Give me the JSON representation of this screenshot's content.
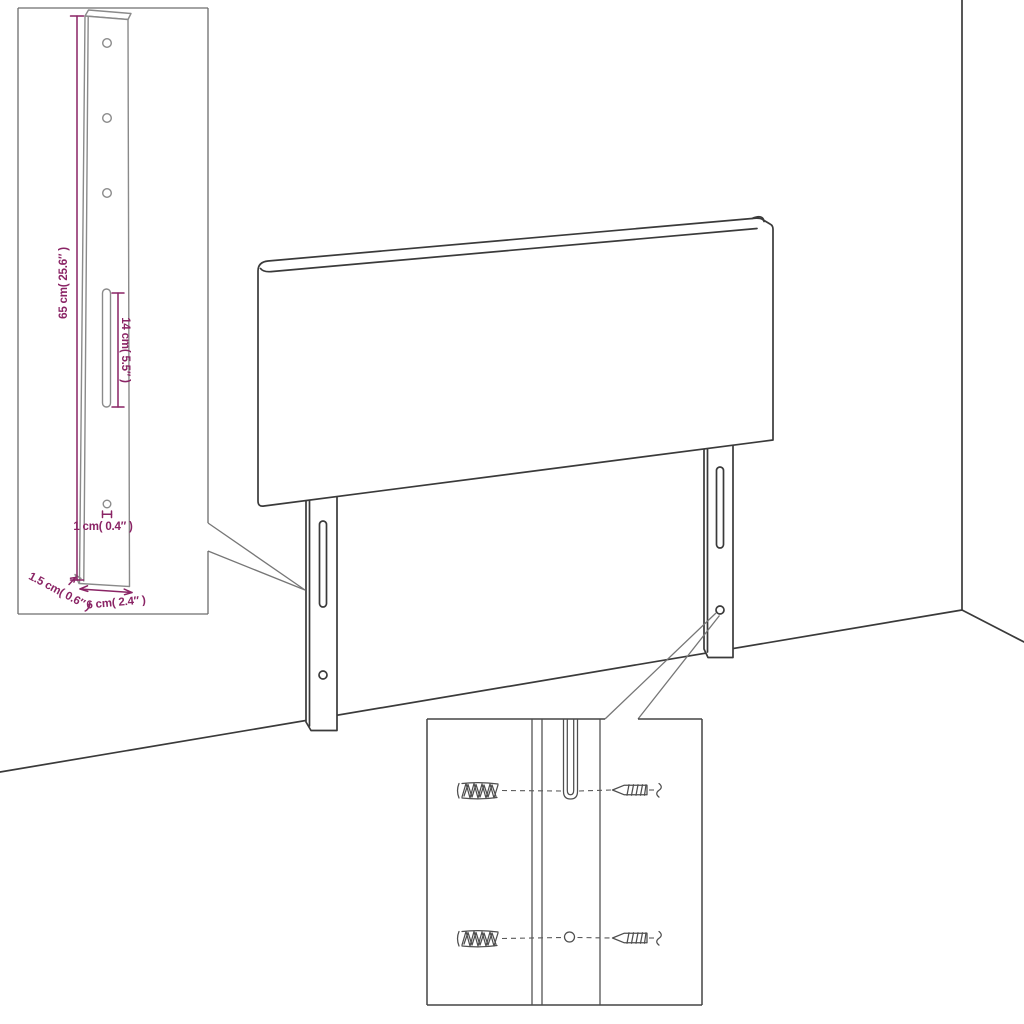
{
  "diagram": {
    "type": "product-dimension-drawing",
    "subject": "upholstered headboard with two mounting legs, wall corner background, leg detail inset and mounting hardware inset"
  },
  "colors": {
    "background": "#ffffff",
    "main_line": "#3a3a3a",
    "inset_line": "#8a8a8a",
    "hardware_line": "#4e4e4e",
    "dimension": "#8a2465"
  },
  "leg_detail_inset": {
    "height_label": "65 cm( 25.6″ )",
    "slot_label": "14 cm( 5.5″ )",
    "hole_label": "1 cm( 0.4″ )",
    "thickness_label": "1.5 cm( 0.6″ )",
    "width_label": "6 cm( 2.4″ )"
  }
}
